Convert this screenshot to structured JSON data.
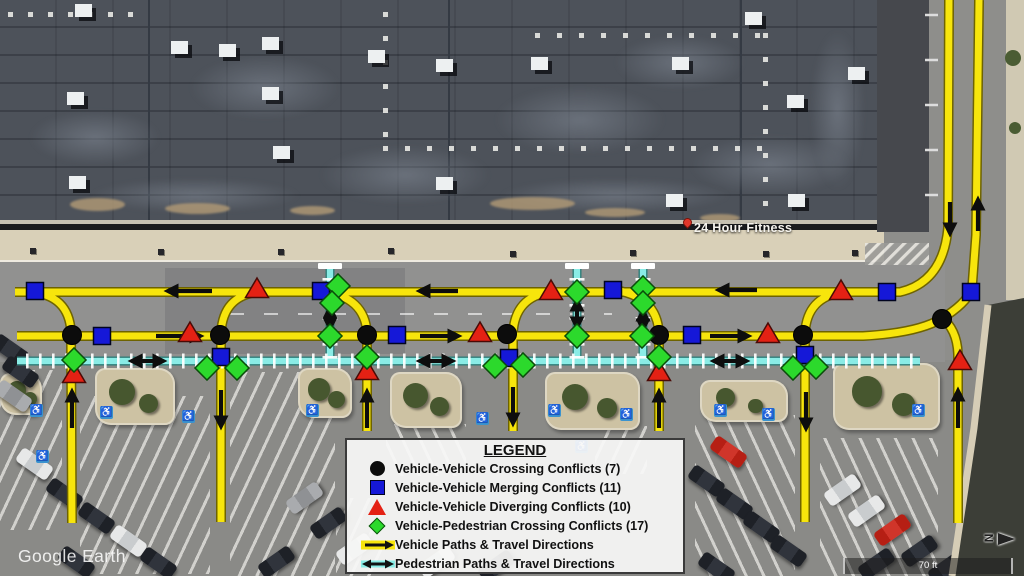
{
  "labels": {
    "place": "24 Hour Fitness",
    "watermark": "Google Earth",
    "scale": "70 ft",
    "compass": "N"
  },
  "legend": {
    "title": "LEGEND",
    "items": [
      {
        "icon": "circle",
        "color": "#0c0c0c",
        "label": "Vehicle-Vehicle Crossing Conflicts (7)"
      },
      {
        "icon": "square",
        "color": "#1518d8",
        "label": "Vehicle-Vehicle Merging Conflicts (11)"
      },
      {
        "icon": "triangle",
        "color": "#e42114",
        "label": "Vehicle-Vehicle Diverging Conflicts (10)"
      },
      {
        "icon": "diamond",
        "color": "#2cd92c",
        "label": "Vehicle-Pedestrian Crossing Conflicts (17)"
      },
      {
        "icon": "vehicle-arrow",
        "color": "#f7e50c",
        "label": "Vehicle Paths & Travel Directions"
      },
      {
        "icon": "pedestrian-arrow",
        "color": "#8aece6",
        "label": "Pedestrian Paths & Travel Directions"
      }
    ]
  },
  "overlay": {
    "colors": {
      "vehicle": "#f7e50c",
      "vehicle_edge": "#6e6300",
      "pedestrian": "#8aece6",
      "pedestrian_edge": "#2f7d78",
      "arrow": "#0d0d0d",
      "crossing": "#0c0c0c",
      "merging": "#1518d8",
      "diverging": "#e42114",
      "ped_crossing": "#2cd92c"
    },
    "vehicle_paths": [
      "M949,0 L948,228 Q943,282 900,292 L15,292",
      "M17,336 L863,336 Q917,333 941,319 Q966,304 972,289 L976,235 L979,0",
      "M941,317 Q957,329 958,354 L958,523",
      "M30,292 Q69,295 71,332 L72,523",
      "M258,292 Q223,296 221,333 L221,522",
      "M322,291 Q365,297 367,333 L367,431",
      "M550,292 Q515,297 513,333 L513,431",
      "M614,290 Q657,296 659,333 L659,431",
      "M843,292 Q807,297 805,333 L805,522"
    ],
    "pedestrian_paths": [
      "M17,361 L920,361",
      "M330,269 L330,360",
      "M577,269 L577,360",
      "M643,269 L643,360"
    ],
    "crosswalk_caps": [
      330,
      577,
      643
    ],
    "vehicle_arrows": [
      [
        212,
        291,
        168,
        291
      ],
      [
        458,
        291,
        420,
        291
      ],
      [
        757,
        290,
        719,
        290
      ],
      [
        156,
        336,
        200,
        336
      ],
      [
        420,
        336,
        458,
        336
      ],
      [
        710,
        336,
        748,
        336
      ],
      [
        72,
        428,
        72,
        392
      ],
      [
        221,
        390,
        221,
        426
      ],
      [
        367,
        428,
        367,
        392
      ],
      [
        513,
        387,
        513,
        423
      ],
      [
        659,
        428,
        659,
        392
      ],
      [
        806,
        392,
        806,
        428
      ],
      [
        958,
        428,
        958,
        391
      ],
      [
        950,
        202,
        950,
        233
      ],
      [
        978,
        231,
        978,
        200
      ]
    ],
    "pedestrian_arrows": [
      [
        132,
        361,
        163,
        361
      ],
      [
        420,
        361,
        452,
        361
      ],
      [
        714,
        361,
        746,
        361
      ],
      [
        330,
        308,
        330,
        328
      ],
      [
        577,
        301,
        577,
        327
      ],
      [
        643,
        311,
        643,
        329
      ]
    ],
    "conflicts": {
      "crossing": [
        [
          72,
          335
        ],
        [
          220,
          335
        ],
        [
          367,
          335
        ],
        [
          507,
          334
        ],
        [
          659,
          335
        ],
        [
          803,
          335
        ],
        [
          942,
          319
        ]
      ],
      "merging": [
        [
          35,
          291
        ],
        [
          102,
          336
        ],
        [
          221,
          357
        ],
        [
          321,
          291
        ],
        [
          397,
          335
        ],
        [
          509,
          358
        ],
        [
          613,
          290
        ],
        [
          692,
          335
        ],
        [
          805,
          355
        ],
        [
          887,
          292
        ],
        [
          971,
          292
        ]
      ],
      "diverging": [
        [
          74,
          374
        ],
        [
          190,
          333
        ],
        [
          257,
          289
        ],
        [
          367,
          371
        ],
        [
          480,
          333
        ],
        [
          551,
          291
        ],
        [
          659,
          372
        ],
        [
          768,
          334
        ],
        [
          841,
          291
        ],
        [
          960,
          361
        ]
      ],
      "ped_crossing": [
        [
          74,
          360
        ],
        [
          207,
          368
        ],
        [
          237,
          368
        ],
        [
          338,
          286
        ],
        [
          332,
          303
        ],
        [
          330,
          336
        ],
        [
          367,
          357
        ],
        [
          495,
          366
        ],
        [
          523,
          365
        ],
        [
          577,
          292
        ],
        [
          577,
          336
        ],
        [
          643,
          288
        ],
        [
          643,
          303
        ],
        [
          642,
          336
        ],
        [
          659,
          357
        ],
        [
          793,
          368
        ],
        [
          816,
          367
        ]
      ]
    }
  },
  "scene": {
    "seams_x": [
      148,
      448,
      740
    ],
    "roof_patches": [
      [
        30,
        110,
        130,
        55
      ],
      [
        190,
        55,
        150,
        65
      ],
      [
        320,
        145,
        170,
        60
      ],
      [
        495,
        85,
        170,
        70
      ],
      [
        615,
        35,
        130,
        55
      ],
      [
        690,
        135,
        160,
        60
      ],
      [
        90,
        178,
        210,
        35
      ],
      [
        500,
        178,
        230,
        35
      ],
      [
        810,
        30,
        55,
        160
      ]
    ],
    "roof_dot_runs": [
      {
        "x": 535,
        "y": 33,
        "n": 11,
        "dx": 22,
        "dy": 0
      },
      {
        "x": 383,
        "y": 146,
        "n": 18,
        "dx": 22,
        "dy": 0
      },
      {
        "x": 8,
        "y": 12,
        "n": 7,
        "dx": 20,
        "dy": 0
      },
      {
        "x": 763,
        "y": 33,
        "n": 8,
        "dx": 0,
        "dy": 24
      },
      {
        "x": 383,
        "y": 12,
        "n": 6,
        "dx": 0,
        "dy": 24
      }
    ],
    "hvac_units": [
      [
        75,
        4
      ],
      [
        67,
        92
      ],
      [
        69,
        176
      ],
      [
        171,
        41
      ],
      [
        219,
        44
      ],
      [
        262,
        37
      ],
      [
        262,
        87
      ],
      [
        273,
        146
      ],
      [
        368,
        50
      ],
      [
        436,
        59
      ],
      [
        436,
        177
      ],
      [
        531,
        57
      ],
      [
        672,
        57
      ],
      [
        745,
        12
      ],
      [
        787,
        95
      ],
      [
        666,
        194
      ],
      [
        788,
        194
      ],
      [
        848,
        67
      ]
    ],
    "dirt_patches": [
      [
        70,
        198,
        55,
        13
      ],
      [
        165,
        203,
        65,
        11
      ],
      [
        290,
        206,
        45,
        9
      ],
      [
        490,
        197,
        85,
        13
      ],
      [
        585,
        208,
        60,
        9
      ],
      [
        700,
        214,
        40,
        8
      ]
    ],
    "sidewalk_posts": [
      [
        30,
        248
      ],
      [
        158,
        249
      ],
      [
        278,
        249
      ],
      [
        388,
        248
      ],
      [
        510,
        251
      ],
      [
        630,
        250
      ],
      [
        763,
        251
      ],
      [
        852,
        250
      ]
    ],
    "stripe_regions": [
      [
        0,
        370,
        62,
        160,
        115
      ],
      [
        80,
        396,
        130,
        178,
        115
      ],
      [
        230,
        372,
        105,
        204,
        115
      ],
      [
        386,
        424,
        80,
        52,
        65
      ],
      [
        595,
        426,
        52,
        48,
        115
      ],
      [
        695,
        415,
        100,
        161,
        65
      ],
      [
        820,
        438,
        118,
        138,
        65
      ],
      [
        336,
        498,
        46,
        78,
        115
      ]
    ],
    "islands": [
      [
        0,
        373,
        42,
        42
      ],
      [
        95,
        368,
        80,
        57
      ],
      [
        298,
        368,
        54,
        50
      ],
      [
        390,
        372,
        72,
        56
      ],
      [
        545,
        372,
        95,
        58
      ],
      [
        700,
        380,
        88,
        42
      ],
      [
        833,
        363,
        107,
        67
      ]
    ],
    "cars": [
      [
        -8,
        342,
        35,
        "dark"
      ],
      [
        2,
        364,
        35,
        "dark"
      ],
      [
        -5,
        388,
        35,
        "silver"
      ],
      [
        16,
        456,
        35,
        "white"
      ],
      [
        46,
        486,
        35,
        "dark"
      ],
      [
        78,
        510,
        35,
        "dark"
      ],
      [
        110,
        533,
        35,
        "white"
      ],
      [
        140,
        555,
        35,
        "dark"
      ],
      [
        58,
        554,
        35,
        "dark"
      ],
      [
        286,
        490,
        -35,
        "silver"
      ],
      [
        310,
        515,
        -35,
        "dark"
      ],
      [
        336,
        541,
        -35,
        "white"
      ],
      [
        258,
        554,
        -35,
        "dark"
      ],
      [
        418,
        554,
        -35,
        "white"
      ],
      [
        478,
        558,
        -35,
        "dark"
      ],
      [
        710,
        444,
        35,
        "red"
      ],
      [
        688,
        473,
        35,
        "dark"
      ],
      [
        716,
        496,
        35,
        "dark"
      ],
      [
        743,
        519,
        35,
        "dark"
      ],
      [
        770,
        543,
        35,
        "dark"
      ],
      [
        698,
        560,
        35,
        "dark"
      ],
      [
        824,
        482,
        -35,
        "white"
      ],
      [
        848,
        503,
        -35,
        "white"
      ],
      [
        874,
        522,
        -35,
        "red"
      ],
      [
        901,
        543,
        -35,
        "dark"
      ],
      [
        928,
        560,
        -35,
        "dark"
      ],
      [
        858,
        556,
        -35,
        "dark"
      ],
      [
        962,
        540,
        -35,
        "dark"
      ]
    ],
    "handicap_spots": [
      [
        30,
        404
      ],
      [
        36,
        450
      ],
      [
        100,
        406
      ],
      [
        182,
        410
      ],
      [
        306,
        404
      ],
      [
        476,
        412
      ],
      [
        548,
        404
      ],
      [
        575,
        440
      ],
      [
        620,
        408
      ],
      [
        714,
        404
      ],
      [
        762,
        408
      ],
      [
        912,
        404
      ]
    ],
    "right_stall_ticks_y": [
      15,
      60,
      105,
      150,
      195
    ],
    "right_bushes": [
      [
        1013,
        58,
        16
      ],
      [
        1015,
        128,
        12
      ]
    ]
  }
}
